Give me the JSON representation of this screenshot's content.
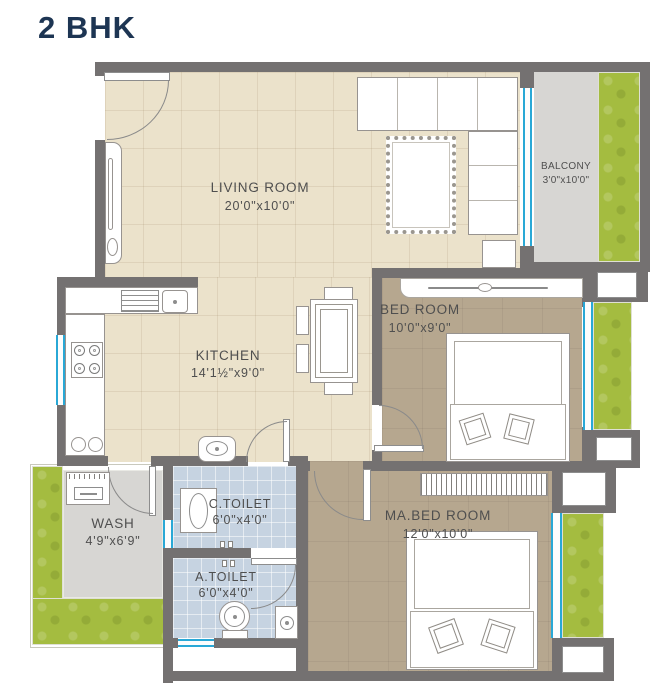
{
  "title": "2 BHK",
  "rooms": {
    "living": {
      "name": "LIVING ROOM",
      "dims": "20'0\"x10'0\""
    },
    "kitchen": {
      "name": "KITCHEN",
      "dims": "14'1½\"x9'0\""
    },
    "bedroom": {
      "name": "BED ROOM",
      "dims": "10'0\"x9'0\""
    },
    "master": {
      "name": "MA.BED ROOM",
      "dims": "12'0\"x10'0\""
    },
    "balcony": {
      "name": "BALCONY",
      "dims": "3'0\"x10'0\""
    },
    "wash": {
      "name": "WASH",
      "dims": "4'9\"x6'9\""
    },
    "c_toilet": {
      "name": "C.TOILET",
      "dims": "6'0\"x4'0\""
    },
    "a_toilet": {
      "name": "A.TOILET",
      "dims": "6'0\"x4'0\""
    }
  },
  "colors": {
    "title": "#1d3553",
    "wall": "#747171",
    "floor_beige": "#ebe2cb",
    "floor_brown": "#b6a78f",
    "floor_gray": "#d7d6d3",
    "floor_blue": "#c6d3e1",
    "lawn_green": "#a4bc40",
    "window_cyan": "#29a8d6",
    "label": "#4f4f4f"
  }
}
